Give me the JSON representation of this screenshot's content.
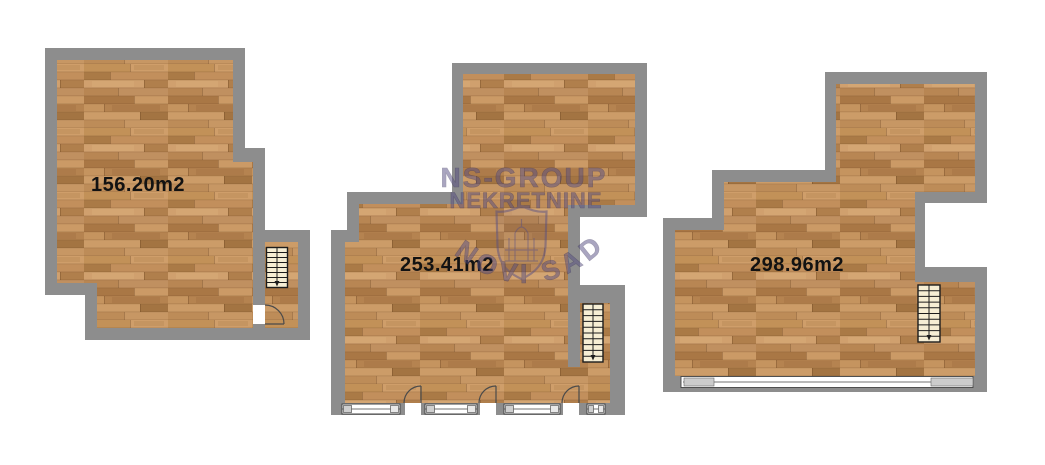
{
  "image": {
    "kind": "real-estate floor plan sheet",
    "background": "#ffffff",
    "units_count": 3
  },
  "colors": {
    "wall_gray": "#8d8d8d",
    "wood_floor_base": "#bb8a57",
    "stairs_fill": "#f6eed4",
    "label_text": "#121212",
    "watermark_purple": "#564e82"
  },
  "plans": [
    {
      "id": "plan-1",
      "area_label": "156.20m2",
      "features": {
        "stairs": 1,
        "doors": 1,
        "windows": 0
      }
    },
    {
      "id": "plan-2",
      "area_label": "253.41m2",
      "features": {
        "stairs": 1,
        "doors": 3,
        "windows": 4
      }
    },
    {
      "id": "plan-3",
      "area_label": "298.96m2",
      "features": {
        "stairs": 1,
        "doors": 0,
        "windows": 1
      }
    }
  ],
  "watermark": {
    "line1": "NS-GROUP",
    "line2": "NEKRETNINE",
    "arc_text": "NOVI SAD",
    "emblem": "shield-crest-icon"
  }
}
